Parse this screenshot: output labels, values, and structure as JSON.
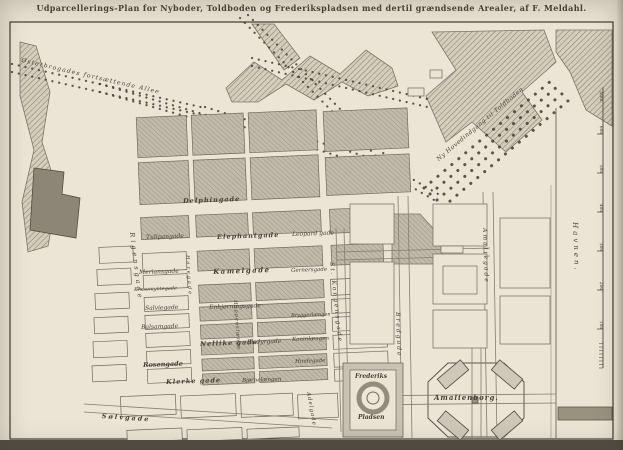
{
  "title": "Udparcellerings-Plan for Nyboder, Toldboden og Frederikspladsen med dertil grændsende Arealer, af F. Meldahl.",
  "colors": {
    "paper": "#eae2d3",
    "ink": "#464035",
    "block_gray": "#c1b9a9",
    "block_white": "#ebe3d4",
    "hatch_band": "#d6cebd",
    "dark_block": "#8d8677",
    "road": "#857d6e",
    "tree_dot": "#4b463d"
  },
  "map": {
    "labels": [
      {
        "n": "label-oesterbro-alle",
        "t": "Østerbrogades fortsættende Allee",
        "x": 22,
        "y": 58,
        "r": 13,
        "s": 6,
        "ls": 1.2
      },
      {
        "n": "label-ny-hovedindgang-til-toldboden",
        "t": "Ny Hovedindgang til Toldboden",
        "x": 436,
        "y": 158,
        "r": -40,
        "s": 6,
        "ls": 0.5
      },
      {
        "n": "label-delfingade",
        "t": "Delphingade",
        "x": 183,
        "y": 198,
        "r": -2,
        "s": 6.5,
        "b": 1,
        "ls": 1
      },
      {
        "n": "label-tulipangade",
        "t": "Tulipangade",
        "x": 146,
        "y": 235,
        "r": -2,
        "s": 6
      },
      {
        "n": "label-elefantgade",
        "t": "Elephantgade",
        "x": 217,
        "y": 234,
        "r": -2,
        "s": 6.5,
        "b": 1,
        "ls": 1
      },
      {
        "n": "label-leopardgade",
        "t": "Leopard gade",
        "x": 292,
        "y": 232,
        "r": -2,
        "s": 6
      },
      {
        "n": "label-meriansgade",
        "t": "Meriansgade",
        "x": 139,
        "y": 270,
        "r": -2,
        "s": 6
      },
      {
        "n": "label-kamelgade",
        "t": "Kamelgade",
        "x": 213,
        "y": 268,
        "r": -2,
        "s": 7,
        "b": 1,
        "ls": 1.5
      },
      {
        "n": "label-gernersgade",
        "t": "Gernersgade",
        "x": 291,
        "y": 269,
        "r": -2,
        "s": 5.5
      },
      {
        "n": "label-krusemyntegade",
        "t": "Krusemyntegade",
        "x": 134,
        "y": 288,
        "r": -2,
        "s": 5
      },
      {
        "n": "label-salviegade",
        "t": "Salviegade",
        "x": 145,
        "y": 306,
        "r": -2,
        "s": 6
      },
      {
        "n": "label-enhjoerningsgade",
        "t": "Enhjørningsgade",
        "x": 209,
        "y": 305,
        "r": -2,
        "s": 6
      },
      {
        "n": "label-bryggerlaengen",
        "t": "Bryggerlængen",
        "x": 291,
        "y": 314,
        "r": -2,
        "s": 5
      },
      {
        "n": "label-balsamgade",
        "t": "Balsamgade",
        "x": 141,
        "y": 325,
        "r": -2,
        "s": 6
      },
      {
        "n": "label-kaninlaengen",
        "t": "Kaninlængen",
        "x": 292,
        "y": 338,
        "r": -2,
        "s": 5.5
      },
      {
        "n": "label-nellikegade",
        "t": "Nellike gade",
        "x": 200,
        "y": 341,
        "r": -2,
        "s": 6.5,
        "b": 1,
        "ls": 1
      },
      {
        "n": "label-elsdyrgade",
        "t": "Elsdyrgade",
        "x": 247,
        "y": 340,
        "r": -2,
        "s": 6
      },
      {
        "n": "label-rosengade",
        "t": "Rosengade",
        "x": 143,
        "y": 362,
        "r": -2,
        "s": 6.5,
        "b": 1
      },
      {
        "n": "label-hindegade",
        "t": "Hindegade",
        "x": 295,
        "y": 360,
        "r": -2,
        "s": 5.5
      },
      {
        "n": "label-klerkegade",
        "t": "Klerke gade",
        "x": 166,
        "y": 379,
        "r": -2,
        "s": 6.5,
        "b": 1,
        "ls": 1
      },
      {
        "n": "label-bjoernelaengen",
        "t": "Bjørnelængen",
        "x": 242,
        "y": 379,
        "r": -2,
        "s": 5.5
      },
      {
        "n": "label-soelvgade",
        "t": "Sølvgade",
        "x": 102,
        "y": 413,
        "r": 4,
        "s": 6.5,
        "b": 1,
        "ls": 2
      },
      {
        "n": "label-rigensgade",
        "t": "Rigensgade",
        "x": 135,
        "y": 232,
        "r": 83,
        "s": 6.5,
        "ls": 3
      },
      {
        "n": "label-haregade",
        "t": "Haregade",
        "x": 189,
        "y": 255,
        "r": 86,
        "s": 5,
        "ls": 2
      },
      {
        "n": "label-hoppenslaenge",
        "t": "Hoppenslænge",
        "x": 237,
        "y": 300,
        "r": 86,
        "s": 5,
        "ls": 1
      },
      {
        "n": "label-st-kongensgade",
        "t": "St. Kongensgade",
        "x": 334,
        "y": 262,
        "r": 84,
        "s": 6,
        "ls": 2
      },
      {
        "n": "label-adelgade",
        "t": "Adelgade",
        "x": 310,
        "y": 392,
        "r": 80,
        "s": 5.5,
        "ls": 1
      },
      {
        "n": "label-bredgade",
        "t": "Bredgade",
        "x": 400,
        "y": 312,
        "r": 88,
        "s": 6,
        "ls": 2
      },
      {
        "n": "label-amaliegade",
        "t": "Amaliegade",
        "x": 487,
        "y": 228,
        "r": 88,
        "s": 6,
        "ls": 2
      },
      {
        "n": "label-frederiks",
        "t": "Frederiks",
        "x": 355,
        "y": 374,
        "r": 0,
        "s": 6,
        "b": 1
      },
      {
        "n": "label-pladsen",
        "t": "Pladsen",
        "x": 358,
        "y": 415,
        "r": 0,
        "s": 6,
        "b": 1
      },
      {
        "n": "label-amalienborg",
        "t": "Amalienborg.",
        "x": 434,
        "y": 394,
        "r": 0,
        "s": 7,
        "b": 1,
        "ls": 1
      },
      {
        "n": "label-havnen",
        "t": "Havnen.",
        "x": 578,
        "y": 222,
        "r": 88,
        "s": 7,
        "ls": 3
      }
    ],
    "scale": {
      "x": 603,
      "y0": 368,
      "step": 39,
      "nums": [
        "100",
        "200",
        "300",
        "400",
        "500",
        "600"
      ],
      "unit": "Alen."
    },
    "avenues": [
      {
        "x1": 12,
        "y1": 64,
        "x2": 205,
        "y2": 108
      },
      {
        "x1": 12,
        "y1": 72,
        "x2": 205,
        "y2": 116
      },
      {
        "x1": 205,
        "y1": 107,
        "x2": 390,
        "y2": 164
      },
      {
        "x1": 205,
        "y1": 115,
        "x2": 390,
        "y2": 172
      },
      {
        "x1": 240,
        "y1": 18,
        "x2": 386,
        "y2": 166
      },
      {
        "x1": 248,
        "y1": 15,
        "x2": 392,
        "y2": 162
      },
      {
        "x1": 100,
        "y1": 84,
        "x2": 213,
        "y2": 117
      },
      {
        "x1": 100,
        "y1": 92,
        "x2": 213,
        "y2": 124
      },
      {
        "x1": 252,
        "y1": 58,
        "x2": 432,
        "y2": 100
      },
      {
        "x1": 252,
        "y1": 66,
        "x2": 432,
        "y2": 108
      },
      {
        "x1": 390,
        "y1": 166,
        "x2": 438,
        "y2": 194
      },
      {
        "x1": 386,
        "y1": 172,
        "x2": 434,
        "y2": 200
      },
      {
        "x1": 424,
        "y1": 188,
        "x2": 552,
        "y2": 80,
        "w": 3
      },
      {
        "x1": 430,
        "y1": 194,
        "x2": 558,
        "y2": 86,
        "w": 3
      },
      {
        "x1": 437,
        "y1": 200,
        "x2": 563,
        "y2": 93,
        "w": 3
      },
      {
        "x1": 443,
        "y1": 207,
        "x2": 569,
        "y2": 100,
        "w": 3
      }
    ],
    "roads": [
      {
        "x1": 336,
        "y1": 228,
        "x2": 341,
        "y2": 432
      },
      {
        "x1": 344,
        "y1": 228,
        "x2": 349,
        "y2": 432
      },
      {
        "x1": 398,
        "y1": 196,
        "x2": 402,
        "y2": 438
      },
      {
        "x1": 408,
        "y1": 196,
        "x2": 412,
        "y2": 438
      },
      {
        "x1": 483,
        "y1": 192,
        "x2": 487,
        "y2": 438
      },
      {
        "x1": 493,
        "y1": 192,
        "x2": 497,
        "y2": 438
      },
      {
        "x1": 337,
        "y1": 252,
        "x2": 490,
        "y2": 248
      },
      {
        "x1": 337,
        "y1": 260,
        "x2": 490,
        "y2": 256
      },
      {
        "x1": 346,
        "y1": 396,
        "x2": 556,
        "y2": 394
      },
      {
        "x1": 346,
        "y1": 405,
        "x2": 556,
        "y2": 403
      },
      {
        "x1": 472,
        "y1": 340,
        "x2": 472,
        "y2": 438
      },
      {
        "x1": 481,
        "y1": 340,
        "x2": 481,
        "y2": 438
      },
      {
        "x1": 84,
        "y1": 404,
        "x2": 338,
        "y2": 420
      },
      {
        "x1": 84,
        "y1": 412,
        "x2": 332,
        "y2": 428
      },
      {
        "x1": 556,
        "y1": 108,
        "x2": 556,
        "y2": 438,
        "w": 1.1
      },
      {
        "x1": 551,
        "y1": 185,
        "x2": 551,
        "y2": 438,
        "w": 0.5
      }
    ],
    "polys": [
      {
        "p": "20,42 36,46 50,92 42,142 58,192 48,246 28,252 22,202 34,150 20,96",
        "f": "hatch"
      },
      {
        "p": "34,168 64,172 62,194 80,198 76,238 30,230",
        "f": "solid",
        "c": "#8d8677"
      },
      {
        "p": "226,88 254,62 282,80 310,56 340,74 366,50 392,68 398,86 368,96 342,82 314,100 286,84 258,102 232,102",
        "f": "hatch"
      },
      {
        "p": "252,24 274,24 300,58 284,70",
        "f": "hatch"
      },
      {
        "p": "432,32 544,30 556,62 522,92 542,120 506,152 472,122 446,142 426,96 456,70",
        "f": "hatch"
      },
      {
        "p": "556,30 612,30 612,126 586,110 570,72 556,52",
        "f": "hatch"
      },
      {
        "p": "392,214 420,214 442,238 442,264 392,264",
        "f": "gb"
      },
      {
        "p": "448,363 504,363 524,382 524,418 504,437 448,437 428,418 428,382",
        "f": "none"
      }
    ],
    "blocks": [
      {
        "x": 143,
        "y": 112,
        "w": 50,
        "h": 40,
        "t": "g"
      },
      {
        "x": 198,
        "y": 112,
        "w": 52,
        "h": 40,
        "t": "g"
      },
      {
        "x": 255,
        "y": 112,
        "w": 68,
        "h": 40,
        "t": "g"
      },
      {
        "x": 330,
        "y": 114,
        "w": 84,
        "h": 40,
        "t": "g"
      },
      {
        "x": 143,
        "y": 157,
        "w": 50,
        "h": 42,
        "t": "g"
      },
      {
        "x": 198,
        "y": 157,
        "w": 52,
        "h": 42,
        "t": "g"
      },
      {
        "x": 255,
        "y": 157,
        "w": 68,
        "h": 42,
        "t": "g"
      },
      {
        "x": 330,
        "y": 160,
        "w": 84,
        "h": 38,
        "t": "g"
      },
      {
        "x": 143,
        "y": 212,
        "w": 48,
        "h": 22,
        "t": "g"
      },
      {
        "x": 198,
        "y": 212,
        "w": 52,
        "h": 22,
        "t": "g"
      },
      {
        "x": 255,
        "y": 212,
        "w": 68,
        "h": 22,
        "t": "g"
      },
      {
        "x": 332,
        "y": 212,
        "w": 56,
        "h": 24,
        "t": "g"
      },
      {
        "x": 198,
        "y": 248,
        "w": 52,
        "h": 20,
        "t": "g"
      },
      {
        "x": 255,
        "y": 248,
        "w": 68,
        "h": 20,
        "t": "g"
      },
      {
        "x": 332,
        "y": 248,
        "w": 52,
        "h": 20,
        "t": "g"
      },
      {
        "x": 198,
        "y": 282,
        "w": 52,
        "h": 18,
        "t": "g"
      },
      {
        "x": 255,
        "y": 282,
        "w": 68,
        "h": 18,
        "t": "g"
      },
      {
        "x": 198,
        "y": 304,
        "w": 52,
        "h": 14,
        "t": "g"
      },
      {
        "x": 255,
        "y": 304,
        "w": 68,
        "h": 14,
        "t": "g"
      },
      {
        "x": 198,
        "y": 322,
        "w": 52,
        "h": 14,
        "t": "g"
      },
      {
        "x": 255,
        "y": 322,
        "w": 68,
        "h": 14,
        "t": "g"
      },
      {
        "x": 198,
        "y": 340,
        "w": 52,
        "h": 12,
        "t": "g"
      },
      {
        "x": 255,
        "y": 340,
        "w": 68,
        "h": 12,
        "t": "g"
      },
      {
        "x": 198,
        "y": 356,
        "w": 52,
        "h": 12,
        "t": "g"
      },
      {
        "x": 255,
        "y": 356,
        "w": 68,
        "h": 12,
        "t": "g"
      },
      {
        "x": 198,
        "y": 371,
        "w": 52,
        "h": 11,
        "t": "g"
      },
      {
        "x": 255,
        "y": 371,
        "w": 68,
        "h": 11,
        "t": "g"
      },
      {
        "x": 143,
        "y": 248,
        "w": 44,
        "h": 18,
        "t": "w"
      },
      {
        "x": 143,
        "y": 270,
        "w": 44,
        "h": 14,
        "t": "w"
      },
      {
        "x": 143,
        "y": 292,
        "w": 44,
        "h": 14,
        "t": "w"
      },
      {
        "x": 143,
        "y": 310,
        "w": 44,
        "h": 14,
        "t": "w"
      },
      {
        "x": 143,
        "y": 328,
        "w": 44,
        "h": 14,
        "t": "w"
      },
      {
        "x": 143,
        "y": 346,
        "w": 44,
        "h": 14,
        "t": "w"
      },
      {
        "x": 143,
        "y": 364,
        "w": 44,
        "h": 14,
        "t": "w"
      },
      {
        "x": 100,
        "y": 240,
        "w": 34,
        "h": 16,
        "t": "w"
      },
      {
        "x": 97,
        "y": 262,
        "w": 34,
        "h": 16,
        "t": "w"
      },
      {
        "x": 94,
        "y": 286,
        "w": 34,
        "h": 16,
        "t": "w"
      },
      {
        "x": 92,
        "y": 310,
        "w": 34,
        "h": 16,
        "t": "w"
      },
      {
        "x": 90,
        "y": 334,
        "w": 34,
        "h": 16,
        "t": "w"
      },
      {
        "x": 88,
        "y": 358,
        "w": 34,
        "h": 16,
        "t": "w"
      },
      {
        "x": 330,
        "y": 282,
        "w": 54,
        "h": 16,
        "t": "w"
      },
      {
        "x": 330,
        "y": 302,
        "w": 54,
        "h": 14,
        "t": "w"
      },
      {
        "x": 330,
        "y": 320,
        "w": 54,
        "h": 14,
        "t": "w"
      },
      {
        "x": 330,
        "y": 338,
        "w": 54,
        "h": 14,
        "t": "w"
      },
      {
        "x": 330,
        "y": 356,
        "w": 54,
        "h": 14,
        "t": "w"
      },
      {
        "x": 330,
        "y": 372,
        "w": 54,
        "h": 12,
        "t": "w"
      },
      {
        "x": 115,
        "y": 390,
        "w": 55,
        "h": 20,
        "t": "w"
      },
      {
        "x": 175,
        "y": 392,
        "w": 55,
        "h": 22,
        "t": "w"
      },
      {
        "x": 235,
        "y": 394,
        "w": 52,
        "h": 22,
        "t": "w"
      },
      {
        "x": 292,
        "y": 396,
        "w": 40,
        "h": 24,
        "t": "w"
      },
      {
        "x": 120,
        "y": 424,
        "w": 55,
        "h": 12,
        "t": "w"
      },
      {
        "x": 180,
        "y": 426,
        "w": 55,
        "h": 12,
        "t": "w"
      },
      {
        "x": 240,
        "y": 428,
        "w": 52,
        "h": 10,
        "t": "w"
      }
    ],
    "blocks2": [
      {
        "x": 350,
        "y": 204,
        "w": 44,
        "h": 40,
        "t": "w"
      },
      {
        "x": 350,
        "y": 262,
        "w": 44,
        "h": 82,
        "t": "w"
      },
      {
        "x": 433,
        "y": 204,
        "w": 54,
        "h": 42,
        "t": "w"
      },
      {
        "x": 433,
        "y": 254,
        "w": 54,
        "h": 50,
        "t": "w"
      },
      {
        "x": 443,
        "y": 266,
        "w": 34,
        "h": 28,
        "t": "w"
      },
      {
        "x": 441,
        "y": 246,
        "w": 22,
        "h": 7,
        "t": "w"
      },
      {
        "x": 433,
        "y": 310,
        "w": 54,
        "h": 38,
        "t": "w"
      },
      {
        "x": 500,
        "y": 218,
        "w": 50,
        "h": 70,
        "t": "w"
      },
      {
        "x": 500,
        "y": 296,
        "w": 50,
        "h": 48,
        "t": "w"
      },
      {
        "x": 408,
        "y": 88,
        "w": 16,
        "h": 8,
        "t": "w"
      },
      {
        "x": 430,
        "y": 70,
        "w": 12,
        "h": 8,
        "t": "w"
      },
      {
        "x": 343,
        "y": 363,
        "w": 60,
        "h": 74,
        "t": "s"
      },
      {
        "x": 350,
        "y": 370,
        "w": 46,
        "h": 60,
        "t": "w"
      },
      {
        "x": 558,
        "y": 407,
        "w": 54,
        "h": 13,
        "t": "d"
      },
      {
        "x": 472,
        "y": 397,
        "w": 6,
        "h": 6,
        "t": "d"
      },
      {
        "x": 438,
        "y": 368,
        "w": 30,
        "h": 13,
        "t": "p",
        "rt": -40
      },
      {
        "x": 492,
        "y": 368,
        "w": 30,
        "h": 13,
        "t": "p",
        "rt": 40
      },
      {
        "x": 438,
        "y": 419,
        "w": 30,
        "h": 13,
        "t": "p",
        "rt": 40
      },
      {
        "x": 492,
        "y": 419,
        "w": 30,
        "h": 13,
        "t": "p",
        "rt": -40
      }
    ],
    "circles": [
      {
        "cx": 373,
        "cy": 398,
        "r": 14,
        "sw": 5,
        "st": "#938c7c",
        "f": "#eee6d7"
      },
      {
        "cx": 373,
        "cy": 398,
        "r": 6,
        "sw": 1,
        "st": "#6d675c",
        "f": "none"
      }
    ]
  }
}
